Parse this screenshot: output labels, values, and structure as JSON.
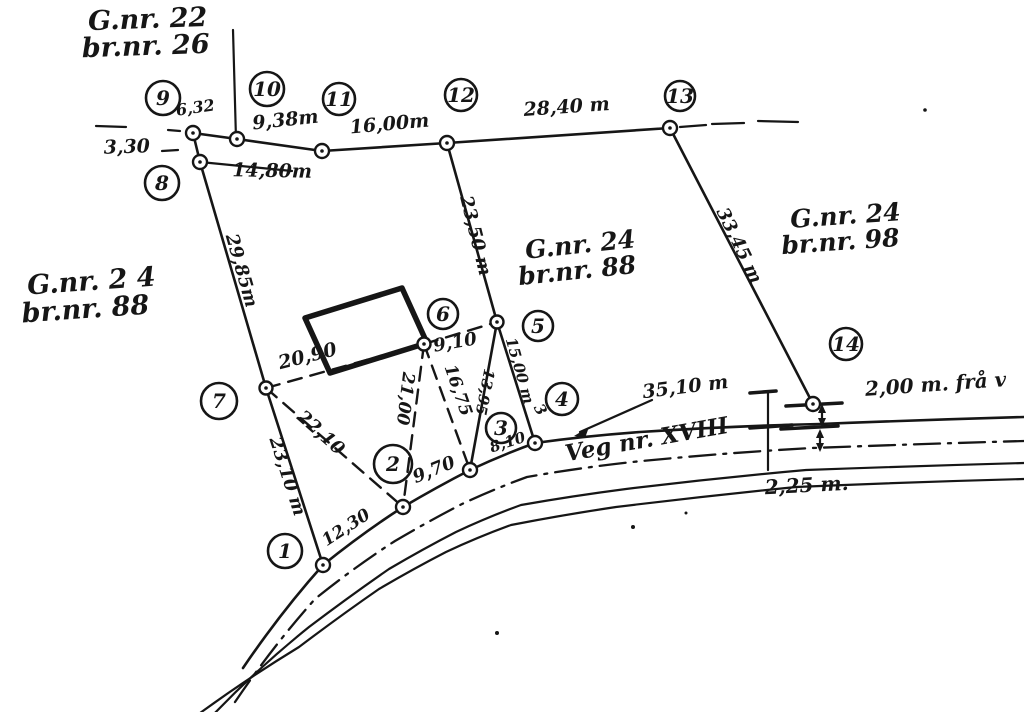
{
  "drawing": {
    "background": "#ffffff",
    "ink": "#161616",
    "type": "hand-drawn cadastral survey sketch"
  },
  "parcels": {
    "top_left": {
      "line1": "G.nr. 22",
      "line2": "br.nr. 26"
    },
    "west": {
      "line1": "G.nr. 2 4",
      "line2": "br.nr. 88"
    },
    "central": {
      "line1": "G.nr. 24",
      "line2": "br.nr. 88"
    },
    "east": {
      "line1": "G.nr. 24",
      "line2": "br.nr. 98"
    }
  },
  "road": {
    "name": "Veg nr. XVIII",
    "width_label": "2,25 m.",
    "offset_label": "2,00 m. frå v",
    "frontage_label": "35,10 m"
  },
  "points": {
    "p1": "1",
    "p2": "2",
    "p3": "3",
    "p4": "4",
    "p5": "5",
    "p6": "6",
    "p7": "7",
    "p8": "8",
    "p9": "9",
    "p10": "10",
    "p11": "11",
    "p12": "12",
    "p13": "13",
    "p14": "14"
  },
  "measurements": {
    "d_9_10": "6,32",
    "d_10_11": "9,38m",
    "d_11_12": "16,00m",
    "d_12_13": "28,40 m",
    "d_9_left": "3,30",
    "d_8_11": "14,80m",
    "d_8_7": "29,85m",
    "d_12_5": "23,50 m",
    "d_13_14": "33,45 m",
    "d_7_6": "20,90",
    "d_6_5": "9,10",
    "d_6_2": "21,00",
    "d_6_3": "16,75",
    "d_5_3": "13,95",
    "d_5_4": "15,00 m",
    "stray_3": "3",
    "d_7_2": "22,10",
    "d_7_1": "23,10 m",
    "d_1_2": "12,30",
    "d_2_3": "9,70",
    "d_3_4": "8,10"
  }
}
